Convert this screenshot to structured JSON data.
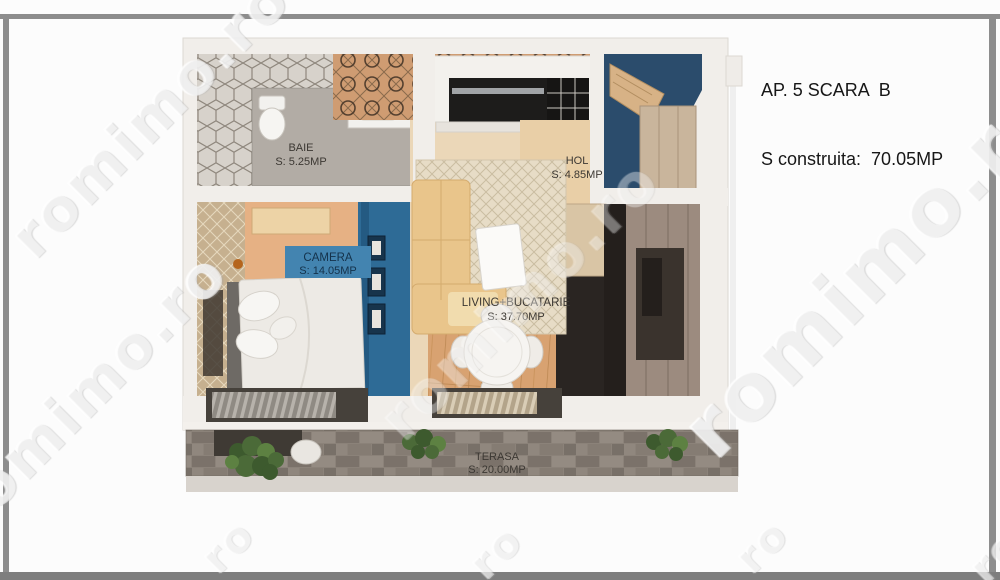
{
  "header": {
    "line1": "AP. 5 SCARA  B",
    "line2": "S construita:  70.05MP"
  },
  "rooms": {
    "baie": {
      "name": "BAIE",
      "area": "S: 5.25MP"
    },
    "camera": {
      "name": "CAMERA",
      "area": "S: 14.05MP"
    },
    "hol": {
      "name": "HOL",
      "area": "S:  4.85MP"
    },
    "living": {
      "name": "LIVING+BUCATARIE",
      "area": "S:  37.70MP"
    },
    "terasa": {
      "name": "TERASA",
      "area": "S: 20.00MP"
    }
  },
  "watermark": {
    "text": "romimo.ro",
    "short": "ro"
  },
  "colors": {
    "frame_gray": "#8d8d8d",
    "wall_white": "#f1eeea",
    "accent_blue_wall": "#2e6b96",
    "camera_label_blue": "#4384b0",
    "hall_blue": "#2b4c6c",
    "bedroom_floor": "#e6b184",
    "living_floor": "#ebd7b8",
    "wood_floor": "#d8a271",
    "terrace_stone": "#8b8279",
    "plant_green": "#4b6a38",
    "kitchen_dark": "#241f1c"
  }
}
